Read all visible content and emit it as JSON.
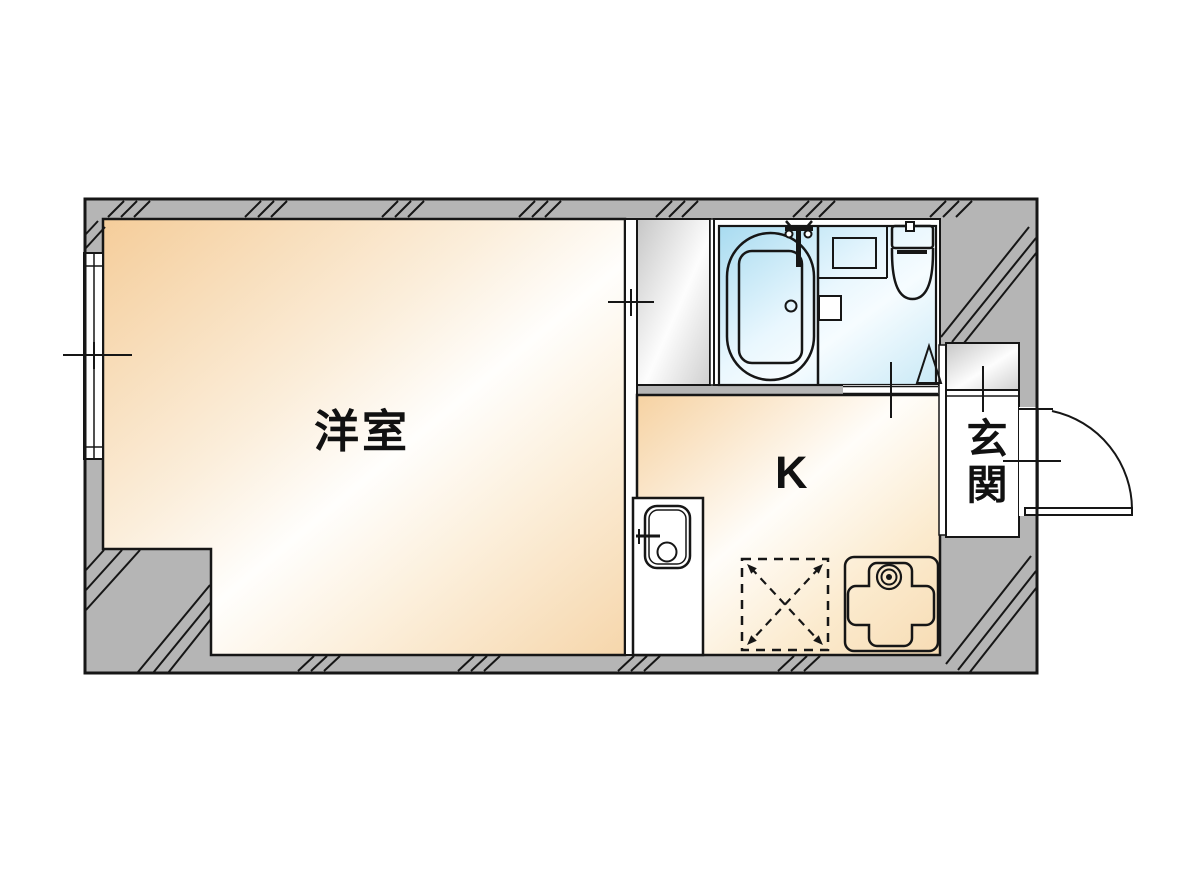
{
  "floorplan": {
    "type": "japanese-apartment-1K-floorplan",
    "labels": {
      "western_room": "洋室",
      "kitchen": "K",
      "entrance": "玄関"
    },
    "fixtures": [
      "bathtub",
      "bath-faucet",
      "washbasin",
      "toilet",
      "bathroom-door",
      "closet",
      "shoe-cabinet",
      "kitchen-sink",
      "gas-stove",
      "appliance-space",
      "entrance-door",
      "window"
    ],
    "colors": {
      "background": "#ffffff",
      "wall_gray": "#b5b5b5",
      "line": "#161616",
      "room_warm_edge": "#f5cd9a",
      "bathroom_blue_edge": "#a8dbf0",
      "closet_gray_edge": "#c6c6c6"
    }
  }
}
